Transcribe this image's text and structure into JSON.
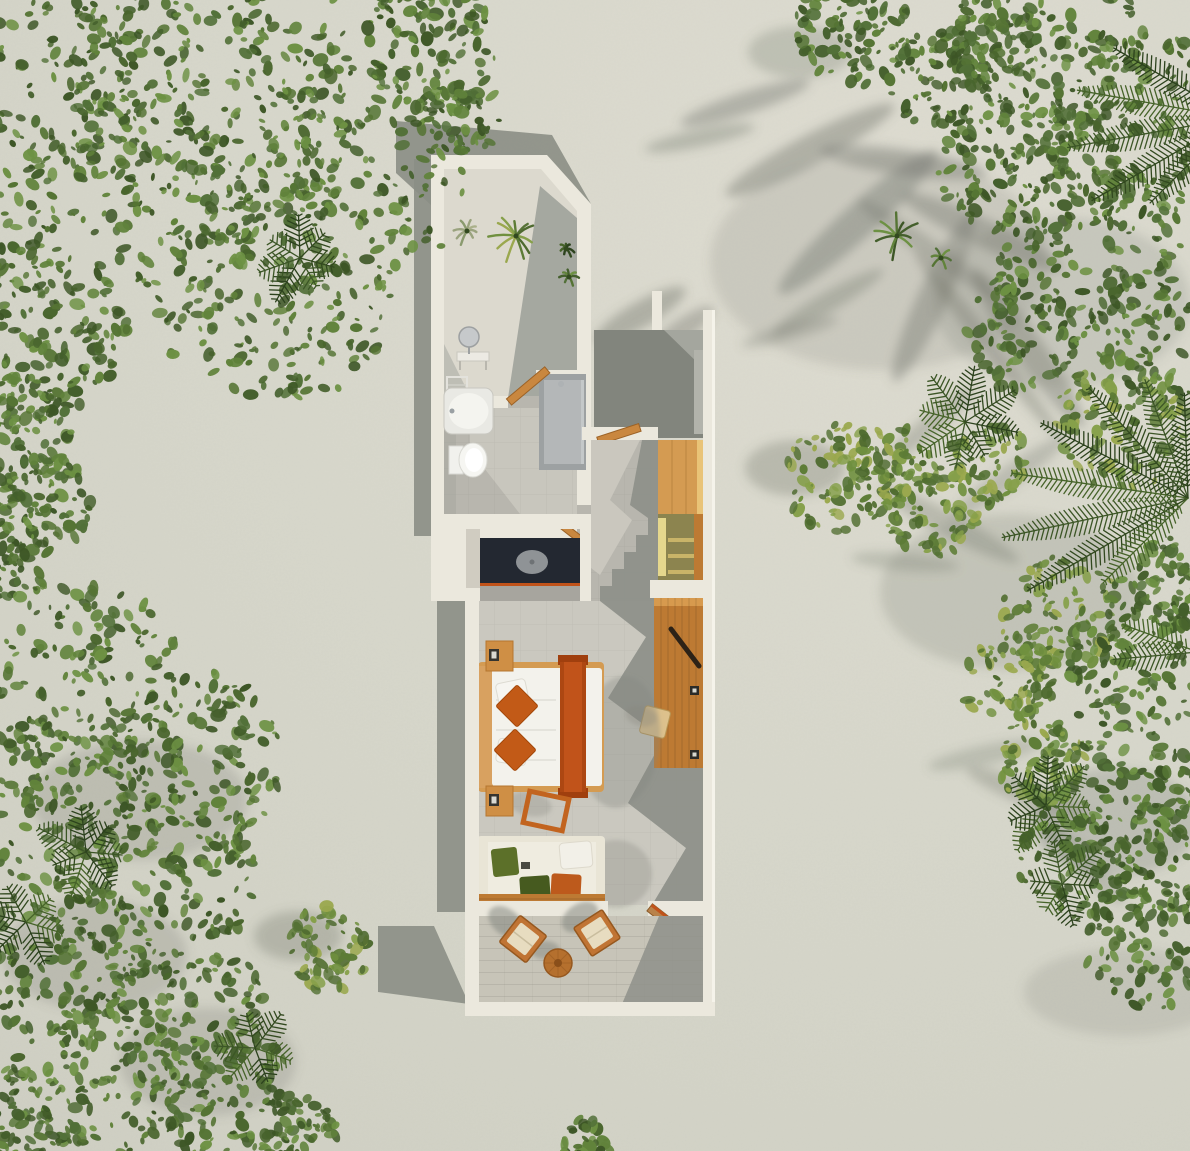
{
  "colors": {
    "sand": "#d6d6ca",
    "sandLight": "#deddd2",
    "shadow": "#8b8e85",
    "vegShadow": "#6e7268",
    "wall": "#ebe8dd",
    "wallLight": "#f5f3ea",
    "courtFloor": "#dcd9ce",
    "floor": "#b8b6ae",
    "floorLit": "#cac8bf",
    "floorShadow": "#8e918a",
    "paving": "#a4a69e",
    "pavingShadow": "#82857d",
    "deck": "#c7c4b8",
    "counter": "#232831",
    "basin": "#8f9396",
    "accent": "#c1531a",
    "accentDark": "#a03f0e",
    "wood": "#bd7a33",
    "woodLight": "#d49b52",
    "woodDeep": "#9c6124",
    "olive": "#8c844f",
    "oliveLight": "#e5d78d",
    "bedWhite": "#f3f2ec",
    "cream": "#e9e5d6",
    "cushGreen": "#5c7029",
    "cushGreenDark": "#465a1f",
    "cushOrange": "#bd5a1c",
    "fixture": "#f4f4ef",
    "shower": "#9da1a2",
    "showerPanel": "#b4b7b8",
    "chrome": "#c6c9cb",
    "handle": "#2c2217",
    "stool": "#ddc18c",
    "chairCushion": "#e7dcc0"
  },
  "scene": {
    "palettes": {
      "g": [
        "#3d5626",
        "#49652d",
        "#557434",
        "#61833b",
        "#6d9143",
        "#527038",
        "#445f2c"
      ],
      "gy": [
        "#4e6a2f",
        "#5d7c36",
        "#70903f",
        "#86a04a",
        "#9aa84e",
        "#577337"
      ],
      "pd": [
        "#32491f",
        "#3c5626",
        "#466329",
        "#2c421d"
      ],
      "pale": [
        "#9aa37e",
        "#aab08a",
        "#8a9a6e"
      ]
    },
    "foliage": [
      {
        "name": "bush-topleft-1",
        "x": 55,
        "y": 50,
        "r": 130,
        "p": "g",
        "seed": 11
      },
      {
        "name": "bush-topleft-2",
        "x": 215,
        "y": 90,
        "r": 150,
        "p": "g",
        "seed": 12
      },
      {
        "name": "bush-topleft-3",
        "x": 360,
        "y": 170,
        "r": 112,
        "p": "g",
        "seed": 13
      },
      {
        "name": "bush-topleft-4",
        "x": 118,
        "y": 232,
        "r": 135,
        "p": "g",
        "seed": 14
      },
      {
        "name": "bush-topleft-5",
        "x": 286,
        "y": 296,
        "r": 108,
        "p": "g",
        "seed": 15
      },
      {
        "name": "bush-topleft-6",
        "x": 28,
        "y": 332,
        "r": 95,
        "p": "g",
        "seed": 16
      },
      {
        "name": "bush-topleft-7",
        "x": 430,
        "y": 42,
        "r": 68,
        "p": "g",
        "seed": 17
      },
      {
        "name": "bush-topleft-8",
        "x": 462,
        "y": 118,
        "r": 38,
        "p": "g",
        "seed": 18
      },
      {
        "name": "bush-left-1",
        "x": 14,
        "y": 432,
        "r": 58,
        "p": "g",
        "seed": 19
      },
      {
        "name": "bush-left-2",
        "x": 44,
        "y": 502,
        "r": 52,
        "p": "g",
        "seed": 20
      },
      {
        "name": "bush-left-3",
        "x": 8,
        "y": 562,
        "r": 44,
        "p": "g",
        "seed": 21
      },
      {
        "name": "bush-bottomleft-1",
        "x": 88,
        "y": 680,
        "r": 95,
        "p": "g",
        "seed": 22
      },
      {
        "name": "bush-bottomleft-2",
        "x": 198,
        "y": 756,
        "r": 88,
        "p": "g",
        "seed": 23
      },
      {
        "name": "bush-bottomleft-3",
        "x": 52,
        "y": 800,
        "r": 85,
        "p": "g",
        "seed": 24
      },
      {
        "name": "bush-bottomleft-4",
        "x": 162,
        "y": 876,
        "r": 95,
        "p": "g",
        "seed": 25
      },
      {
        "name": "bush-bottomleft-5",
        "x": 62,
        "y": 962,
        "r": 85,
        "p": "g",
        "seed": 26
      },
      {
        "name": "bush-bottomleft-6",
        "x": 185,
        "y": 1012,
        "r": 80,
        "p": "g",
        "seed": 27
      },
      {
        "name": "bush-bottomleft-7",
        "x": 95,
        "y": 1082,
        "r": 90,
        "p": "g",
        "seed": 28
      },
      {
        "name": "bush-bottomleft-8",
        "x": 228,
        "y": 1106,
        "r": 75,
        "p": "g",
        "seed": 29
      },
      {
        "name": "bush-bottomleft-9",
        "x": 18,
        "y": 1126,
        "r": 60,
        "p": "g",
        "seed": 30
      },
      {
        "name": "bush-bottomleft-10",
        "x": 295,
        "y": 1140,
        "r": 45,
        "p": "g",
        "seed": 31
      },
      {
        "name": "bush-small-left",
        "x": 328,
        "y": 948,
        "r": 44,
        "p": "gy",
        "seed": 32
      },
      {
        "name": "bush-topmid-1",
        "x": 852,
        "y": 26,
        "r": 60,
        "p": "g",
        "seed": 33
      },
      {
        "name": "bush-topmid-2",
        "x": 934,
        "y": 74,
        "r": 52,
        "p": "g",
        "seed": 34
      },
      {
        "name": "bush-topmid-3",
        "x": 992,
        "y": 38,
        "r": 45,
        "p": "g",
        "seed": 35
      },
      {
        "name": "bush-right-1",
        "x": 1052,
        "y": 62,
        "r": 100,
        "p": "g",
        "seed": 36
      },
      {
        "name": "bush-right-2",
        "x": 1150,
        "y": 132,
        "r": 100,
        "p": "g",
        "seed": 37
      },
      {
        "name": "bush-right-3",
        "x": 1002,
        "y": 162,
        "r": 68,
        "p": "g",
        "seed": 38
      },
      {
        "name": "bush-right-4",
        "x": 1092,
        "y": 252,
        "r": 95,
        "p": "g",
        "seed": 39
      },
      {
        "name": "bush-right-5",
        "x": 1170,
        "y": 332,
        "r": 80,
        "p": "g",
        "seed": 40
      },
      {
        "name": "bush-right-6",
        "x": 1022,
        "y": 332,
        "r": 58,
        "p": "g",
        "seed": 41
      },
      {
        "name": "bush-right-7",
        "x": 1122,
        "y": 422,
        "r": 68,
        "p": "gy",
        "seed": 42
      },
      {
        "name": "bush-entry",
        "x": 838,
        "y": 478,
        "r": 54,
        "p": "gy",
        "seed": 43
      },
      {
        "name": "bush-right-8",
        "x": 892,
        "y": 472,
        "r": 48,
        "p": "gy",
        "seed": 44
      },
      {
        "name": "bush-right-9",
        "x": 932,
        "y": 512,
        "r": 46,
        "p": "gy",
        "seed": 45
      },
      {
        "name": "bush-right-10",
        "x": 986,
        "y": 462,
        "r": 42,
        "p": "gy",
        "seed": 46
      },
      {
        "name": "bush-rightmid-1",
        "x": 1062,
        "y": 622,
        "r": 66,
        "p": "gy",
        "seed": 47
      },
      {
        "name": "bush-rightmid-2",
        "x": 1142,
        "y": 652,
        "r": 78,
        "p": "g",
        "seed": 48
      },
      {
        "name": "bush-rightmid-3",
        "x": 1186,
        "y": 582,
        "r": 52,
        "p": "g",
        "seed": 49
      },
      {
        "name": "bush-rightmid-4",
        "x": 1012,
        "y": 682,
        "r": 48,
        "p": "gy",
        "seed": 50
      },
      {
        "name": "bush-rightbottom-1",
        "x": 1112,
        "y": 782,
        "r": 85,
        "p": "g",
        "seed": 51
      },
      {
        "name": "bush-rightbottom-2",
        "x": 1186,
        "y": 852,
        "r": 75,
        "p": "g",
        "seed": 52
      },
      {
        "name": "bush-rightbottom-3",
        "x": 1076,
        "y": 862,
        "r": 58,
        "p": "g",
        "seed": 53
      },
      {
        "name": "bush-rightbottom-4",
        "x": 1152,
        "y": 942,
        "r": 68,
        "p": "g",
        "seed": 54
      },
      {
        "name": "bush-rightbottom-5",
        "x": 1042,
        "y": 762,
        "r": 44,
        "p": "gy",
        "seed": 55
      },
      {
        "name": "bush-bottomcenter",
        "x": 586,
        "y": 1142,
        "r": 24,
        "p": "g",
        "seed": 56
      }
    ],
    "fronds": [
      {
        "x": 1188,
        "y": 498,
        "a": 150,
        "len": 185
      },
      {
        "x": 1188,
        "y": 498,
        "a": 168,
        "len": 190
      },
      {
        "x": 1188,
        "y": 498,
        "a": 188,
        "len": 178
      },
      {
        "x": 1188,
        "y": 498,
        "a": 207,
        "len": 165
      },
      {
        "x": 1188,
        "y": 498,
        "a": 228,
        "len": 148
      },
      {
        "x": 1188,
        "y": 498,
        "a": 250,
        "len": 126
      },
      {
        "x": 1188,
        "y": 498,
        "a": 135,
        "len": 120
      },
      {
        "x": 1188,
        "y": 498,
        "a": 268,
        "len": 105
      },
      {
        "x": 1235,
        "y": 118,
        "a": 150,
        "len": 165
      },
      {
        "x": 1235,
        "y": 118,
        "a": 170,
        "len": 170
      },
      {
        "x": 1235,
        "y": 118,
        "a": 190,
        "len": 160
      },
      {
        "x": 1235,
        "y": 118,
        "a": 210,
        "len": 140
      },
      {
        "x": 1235,
        "y": 118,
        "a": 135,
        "len": 120
      },
      {
        "x": 1198,
        "y": 652,
        "a": 175,
        "len": 85
      },
      {
        "x": 1198,
        "y": 652,
        "a": 200,
        "len": 80
      }
    ],
    "palms": [
      {
        "name": "palm-rosette-1",
        "x": 965,
        "y": 422,
        "r": 50,
        "n": 8,
        "seed": 61
      },
      {
        "name": "palm-rosette-2",
        "x": 300,
        "y": 258,
        "r": 42,
        "n": 7,
        "seed": 62
      },
      {
        "name": "palm-rosette-3",
        "x": 86,
        "y": 852,
        "r": 46,
        "n": 7,
        "seed": 63
      },
      {
        "name": "palm-rosette-4",
        "x": 26,
        "y": 922,
        "r": 40,
        "n": 6,
        "seed": 64
      },
      {
        "name": "palm-rosette-5",
        "x": 1046,
        "y": 806,
        "r": 46,
        "n": 7,
        "seed": 65
      },
      {
        "name": "palm-rosette-6",
        "x": 1062,
        "y": 884,
        "r": 42,
        "n": 6,
        "seed": 66
      },
      {
        "name": "palm-rosette-7",
        "x": 255,
        "y": 1048,
        "r": 40,
        "n": 6,
        "seed": 67
      }
    ],
    "sprigs": [
      {
        "name": "courtyard-plant-large",
        "x": 516,
        "y": 236,
        "r": 27,
        "n": 11,
        "p": "gy",
        "seed": 71
      },
      {
        "name": "courtyard-plant-pale",
        "x": 467,
        "y": 231,
        "r": 15,
        "n": 8,
        "p": "pale",
        "seed": 72
      },
      {
        "name": "courtyard-plant-dark",
        "x": 566,
        "y": 249,
        "r": 9,
        "n": 7,
        "p": "pd",
        "seed": 73
      },
      {
        "name": "courtyard-plant-green",
        "x": 569,
        "y": 277,
        "r": 11,
        "n": 7,
        "p": "g",
        "seed": 74
      },
      {
        "name": "sand-palm-1",
        "x": 897,
        "y": 236,
        "r": 24,
        "n": 10,
        "p": "g",
        "seed": 75
      },
      {
        "name": "sand-palm-2",
        "x": 941,
        "y": 258,
        "r": 11,
        "n": 6,
        "p": "g",
        "seed": 76
      }
    ],
    "soft_shadows": [
      {
        "x": 880,
        "y": 262,
        "rx": 170,
        "ry": 108,
        "rot": 0,
        "o": 0.16
      },
      {
        "x": 1010,
        "y": 592,
        "rx": 130,
        "ry": 78,
        "rot": 0,
        "o": 0.2
      },
      {
        "x": 1124,
        "y": 992,
        "rx": 100,
        "ry": 44,
        "rot": 0,
        "o": 0.16
      },
      {
        "x": 1062,
        "y": 302,
        "rx": 128,
        "ry": 85,
        "rot": 0,
        "o": 0.18
      },
      {
        "x": 810,
        "y": 150,
        "rx": 95,
        "ry": 15,
        "rot": -28,
        "o": 0.4
      },
      {
        "x": 745,
        "y": 103,
        "rx": 68,
        "ry": 11,
        "rot": -18,
        "o": 0.38
      },
      {
        "x": 858,
        "y": 222,
        "rx": 106,
        "ry": 17,
        "rot": -42,
        "o": 0.4
      },
      {
        "x": 933,
        "y": 298,
        "rx": 92,
        "ry": 15,
        "rot": -65,
        "o": 0.38
      },
      {
        "x": 903,
        "y": 162,
        "rx": 84,
        "ry": 13,
        "rot": 8,
        "o": 0.38
      },
      {
        "x": 982,
        "y": 232,
        "rx": 88,
        "ry": 14,
        "rot": 25,
        "o": 0.38
      },
      {
        "x": 1028,
        "y": 348,
        "rx": 96,
        "ry": 15,
        "rot": 55,
        "o": 0.38
      },
      {
        "x": 700,
        "y": 138,
        "rx": 56,
        "ry": 9,
        "rot": -12,
        "o": 0.32
      },
      {
        "x": 930,
        "y": 250,
        "rx": 88,
        "ry": 10,
        "rot": 35,
        "o": 0.3
      },
      {
        "x": 988,
        "y": 345,
        "rx": 118,
        "ry": 9,
        "rot": 52,
        "o": 0.34
      },
      {
        "x": 828,
        "y": 302,
        "rx": 64,
        "ry": 10,
        "rot": -30,
        "o": 0.32
      },
      {
        "x": 790,
        "y": 332,
        "rx": 50,
        "ry": 8,
        "rot": -15,
        "o": 0.28
      },
      {
        "x": 950,
        "y": 525,
        "rx": 78,
        "ry": 12,
        "rot": 28,
        "o": 0.3
      },
      {
        "x": 1008,
        "y": 478,
        "rx": 70,
        "ry": 11,
        "rot": -35,
        "o": 0.28
      },
      {
        "x": 905,
        "y": 562,
        "rx": 54,
        "ry": 9,
        "rot": 5,
        "o": 0.26
      },
      {
        "x": 1030,
        "y": 795,
        "rx": 68,
        "ry": 12,
        "rot": 22,
        "o": 0.3
      },
      {
        "x": 985,
        "y": 755,
        "rx": 58,
        "ry": 10,
        "rot": -12,
        "o": 0.26
      },
      {
        "x": 1078,
        "y": 858,
        "rx": 64,
        "ry": 11,
        "rot": 45,
        "o": 0.28
      },
      {
        "x": 795,
        "y": 468,
        "rx": 50,
        "ry": 28,
        "rot": 0,
        "o": 0.3
      },
      {
        "x": 298,
        "y": 936,
        "rx": 44,
        "ry": 25,
        "rot": 0,
        "o": 0.3
      },
      {
        "x": 140,
        "y": 800,
        "rx": 108,
        "ry": 60,
        "rot": 0,
        "o": 0.22
      },
      {
        "x": 95,
        "y": 955,
        "rx": 92,
        "ry": 55,
        "rot": 0,
        "o": 0.22
      },
      {
        "x": 208,
        "y": 1062,
        "rx": 88,
        "ry": 54,
        "rot": 0,
        "o": 0.22
      },
      {
        "x": 1115,
        "y": 822,
        "rx": 84,
        "ry": 54,
        "rot": 0,
        "o": 0.24
      },
      {
        "x": 800,
        "y": 52,
        "rx": 52,
        "ry": 26,
        "rot": 0,
        "o": 0.26
      },
      {
        "x": 930,
        "y": 425,
        "rx": 55,
        "ry": 10,
        "rot": -40,
        "o": 0.3
      },
      {
        "x": 640,
        "y": 315,
        "rx": 52,
        "ry": 13,
        "rot": -30,
        "o": 0.4
      },
      {
        "x": 682,
        "y": 330,
        "rx": 38,
        "ry": 11,
        "rot": -35,
        "o": 0.36
      }
    ]
  }
}
